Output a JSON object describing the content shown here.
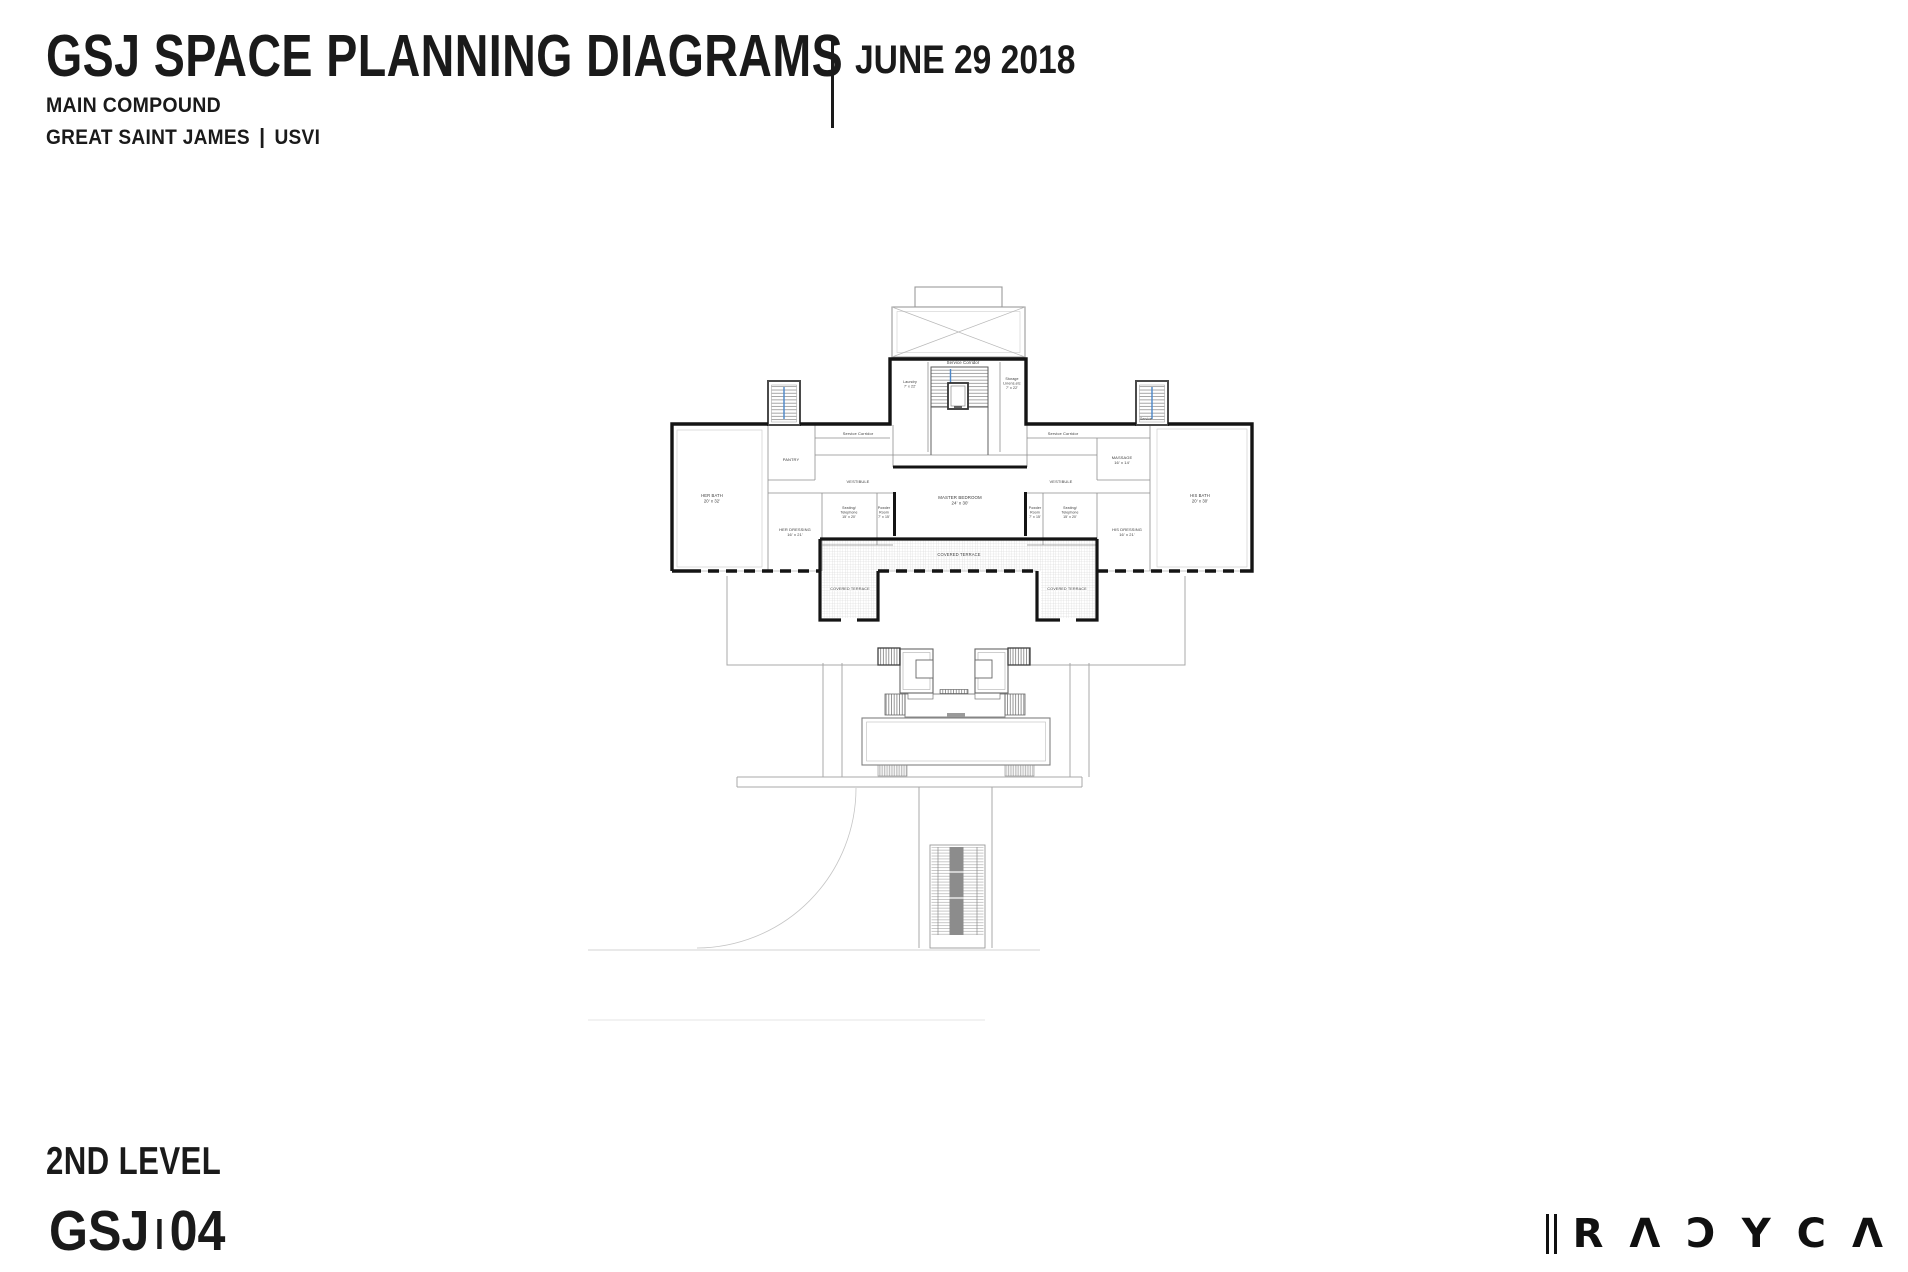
{
  "header": {
    "title": "GSJ SPACE PLANNING DIAGRAMS",
    "date": "JUNE 29 2018",
    "subtitle1": "MAIN COMPOUND",
    "subtitle2": "GREAT SAINT JAMES",
    "subtitle2b": "USVI"
  },
  "footer": {
    "level_label": "2ND LEVEL",
    "sheet_prefix": "GSJ",
    "sheet_number": "04"
  },
  "logo": {
    "letters": [
      "R",
      "Λ",
      "Ɔ",
      "Y",
      "C",
      "Λ"
    ]
  },
  "plan": {
    "colors": {
      "wall": "#141414",
      "partition": "#8f8f8f",
      "light": "#a8a8a8",
      "stairblue": "#4a86c8",
      "label": "#3a3a3a"
    },
    "rooms": [
      {
        "lines": [
          "Service Corridor"
        ],
        "x": 963,
        "y": 364,
        "size": 4.3
      },
      {
        "lines": [
          "Laundry",
          "7' x 22'"
        ],
        "x": 910,
        "y": 383,
        "size": 3.6
      },
      {
        "lines": [
          "Storage",
          "Linens,etc",
          "7' x 22'"
        ],
        "x": 1012,
        "y": 380,
        "size": 3.6
      },
      {
        "lines": [
          "Service Corridor"
        ],
        "x": 858,
        "y": 435,
        "size": 4
      },
      {
        "lines": [
          "Service Corridor"
        ],
        "x": 1063,
        "y": 435,
        "size": 4
      },
      {
        "lines": [
          "Service"
        ],
        "x": 1146,
        "y": 420,
        "size": 3.4
      },
      {
        "lines": [
          "PANTRY"
        ],
        "x": 791,
        "y": 461,
        "size": 4
      },
      {
        "lines": [
          "VESTIBULE"
        ],
        "x": 858,
        "y": 483,
        "size": 4
      },
      {
        "lines": [
          "VESTIBULE"
        ],
        "x": 1061,
        "y": 483,
        "size": 4
      },
      {
        "lines": [
          "MASSAGE",
          "16' x 14'"
        ],
        "x": 1122,
        "y": 459,
        "size": 4
      },
      {
        "lines": [
          "HER BATH",
          "20' x 32'"
        ],
        "x": 712,
        "y": 497,
        "size": 4.2
      },
      {
        "lines": [
          "MASTER BEDROOM",
          "24' x 30'"
        ],
        "x": 960,
        "y": 499,
        "size": 4.4
      },
      {
        "lines": [
          "HIS BATH",
          "20' x 30'"
        ],
        "x": 1200,
        "y": 497,
        "size": 4.2
      },
      {
        "lines": [
          "Seating/",
          "Telephone",
          "15' x 20'"
        ],
        "x": 849,
        "y": 509,
        "size": 3.5
      },
      {
        "lines": [
          "Powder",
          "Room",
          "7' x 15'"
        ],
        "x": 884,
        "y": 509,
        "size": 3.5
      },
      {
        "lines": [
          "Powder",
          "Room",
          "7' x 15'"
        ],
        "x": 1035,
        "y": 509,
        "size": 3.5
      },
      {
        "lines": [
          "Seating/",
          "Telephone",
          "15' x 20'"
        ],
        "x": 1070,
        "y": 509,
        "size": 3.5
      },
      {
        "lines": [
          "HER DRESSING",
          "16' x 21'"
        ],
        "x": 795,
        "y": 531,
        "size": 4
      },
      {
        "lines": [
          "HIS DRESSING",
          "16' x 21'"
        ],
        "x": 1127,
        "y": 531,
        "size": 4
      },
      {
        "lines": [
          "COVERED TERRACE"
        ],
        "x": 959,
        "y": 556,
        "size": 4.2,
        "halo": true
      },
      {
        "lines": [
          "COVERED TERRACE"
        ],
        "x": 850,
        "y": 590,
        "size": 3.8,
        "halo": true
      },
      {
        "lines": [
          "COVERED TERRACE"
        ],
        "x": 1067,
        "y": 590,
        "size": 3.8,
        "halo": true
      }
    ]
  }
}
